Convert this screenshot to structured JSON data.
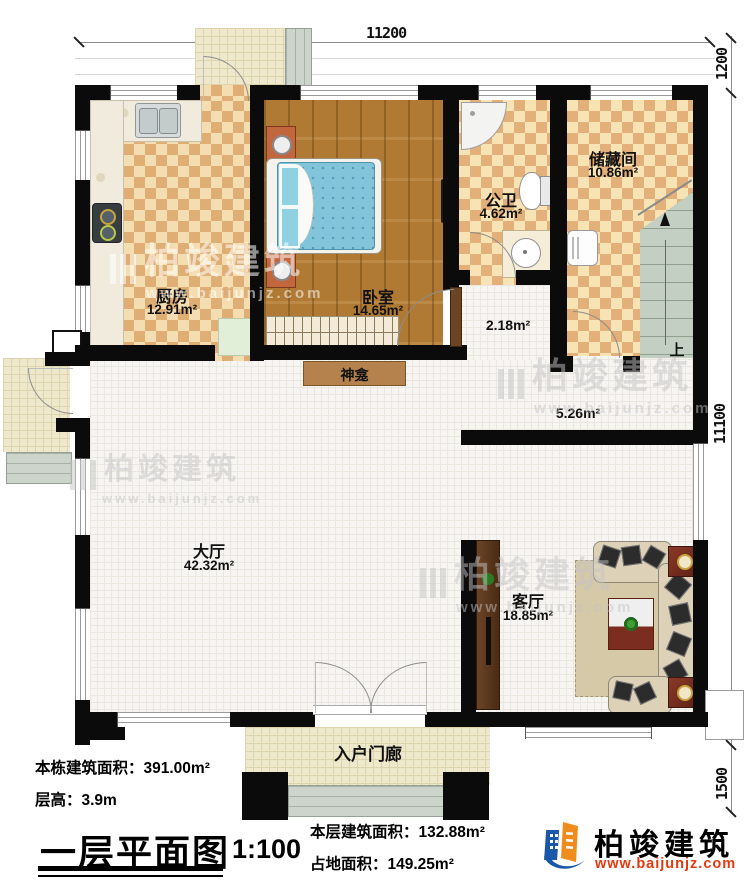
{
  "dimensions": {
    "top": "11200",
    "right_top": "1200",
    "right_mid": "11100",
    "right_bottom": "1500"
  },
  "rooms": {
    "kitchen": {
      "name": "厨房",
      "area": "12.91m²"
    },
    "bedroom": {
      "name": "卧室",
      "area": "14.65m²"
    },
    "bathroom": {
      "name": "公卫",
      "area": "4.62m²"
    },
    "storage": {
      "name": "储藏间",
      "area": "10.86m²"
    },
    "hall": {
      "name": "大厅",
      "area": "42.32m²"
    },
    "living": {
      "name": "客厅",
      "area": "18.85m²"
    },
    "corridor": {
      "area": "5.26m²"
    },
    "vestibule": {
      "area": "2.18m²"
    },
    "entry_porch": {
      "name": "入户门廊"
    },
    "shrine": {
      "name": "神龛"
    },
    "stairs": {
      "up_label": "上"
    }
  },
  "annotations": {
    "total_area": "本栋建筑面积：391.00m²",
    "floor_height": "层高：3.9m",
    "plan_title": "一层平面图",
    "scale": "1:100",
    "floor_area": "本层建筑面积：132.88m²",
    "footprint_area": "占地面积：149.25m²"
  },
  "branding": {
    "logo_name": "柏竣建筑",
    "logo_url": "www.baijunjz.com"
  },
  "watermark": {
    "text": "柏竣建筑",
    "url": "www.baijunjz.com"
  }
}
